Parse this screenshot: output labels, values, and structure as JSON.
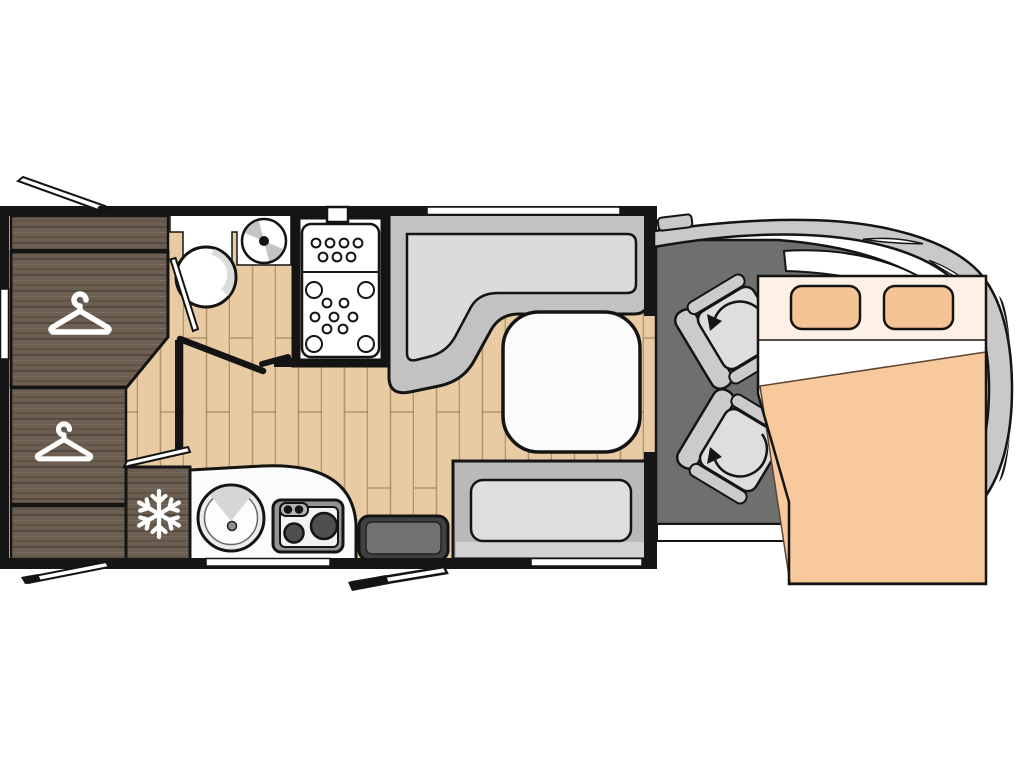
{
  "diagram": {
    "label": "Motorhome floor plan, top view, cab at right with drop-down bed",
    "areas": {
      "rear_left": "wardrobe cabinets",
      "mid_left": "bathroom with toilet, fan and shower",
      "mid_bottom": "kitchen with fridge, sink and hob",
      "mid_right": "L-shaped lounge with table and bench seat",
      "front": "driver cab with two swivel seats and drop-down double bed"
    },
    "icons": [
      {
        "name": "hanger-icon",
        "meaning": "wardrobe",
        "count": 2
      },
      {
        "name": "snowflake-icon",
        "meaning": "refrigerator",
        "count": 1
      },
      {
        "name": "rotation-arrow-icon",
        "meaning": "swivel seat",
        "count": 2
      }
    ],
    "fixtures": [
      "overhead locker",
      "wardrobe",
      "lower wardrobe",
      "refrigerator",
      "toilet",
      "roof fan",
      "shower tray",
      "bathroom door",
      "entry door",
      "kitchen counter",
      "round sink",
      "two-burner hob",
      "entry step box",
      "L-shaped sofa",
      "lounge table",
      "bench seat",
      "driver swivel seat",
      "passenger swivel seat",
      "drop-down bed",
      "pillows",
      "windshield",
      "open window flaps"
    ]
  },
  "colors": {
    "floor_wood": "#e8cba3",
    "dark_wood": "#6c5f51",
    "wall": "#161616",
    "cab_floor": "#6f6f6f",
    "body_gray": "#c9c9c9",
    "sofa_outer": "#c2c2c2",
    "sofa_cushion": "#dbdbdb",
    "bench_outer": "#b9b9b9",
    "bench_base": "#d3d3d3",
    "bench_cushion": "#dedede",
    "table_white": "#fbfbfb",
    "seat_gray": "#cbcbcb",
    "seat_cushion": "#dedede",
    "bed_header": "#fcf1e4",
    "bed_peach": "#f7c99c",
    "pillow": "#f5c494",
    "step_outer": "#404040",
    "step_inner": "#717171",
    "stove_frame": "#949494",
    "stove_panel": "#f2f2f2",
    "knob_strip": "#b5b5b5",
    "burner": "#4f4f4f",
    "fan_blade": "#c4c4c4",
    "sink_shade": "#d6d6d6",
    "toilet_shade": "#dcdcdc",
    "icon_white": "#ffffff",
    "white": "#ffffff"
  }
}
